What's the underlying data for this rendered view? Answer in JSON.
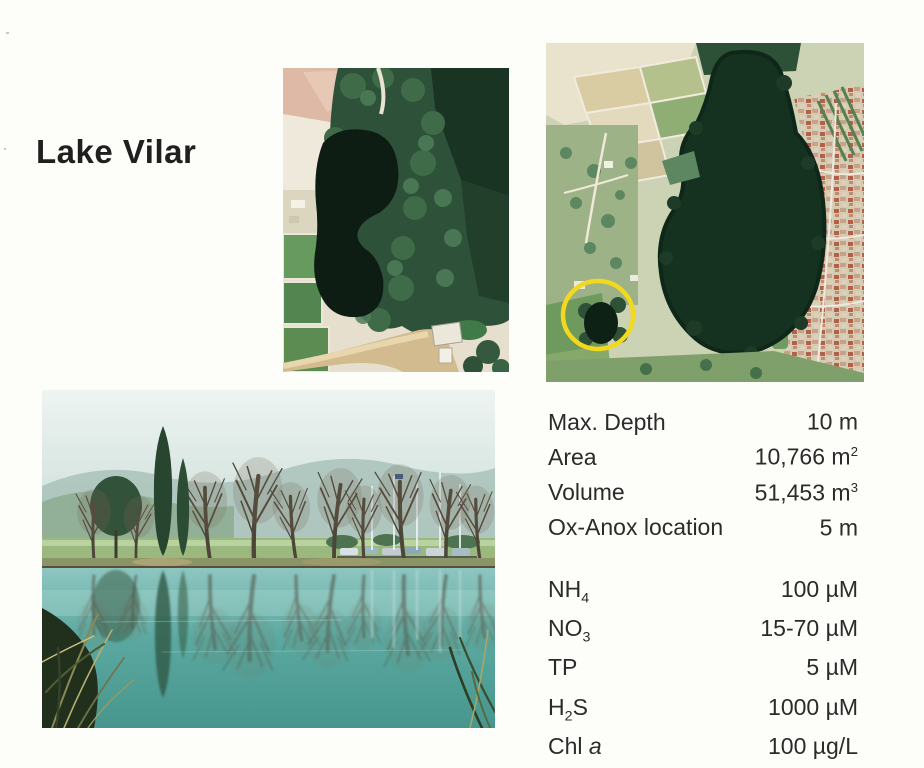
{
  "page": {
    "title": "Lake Vilar",
    "background": "#fdfdfa"
  },
  "colors": {
    "highlight_circle": "#f2d81e",
    "text": "#262626",
    "lake_dark": "#0d1f14",
    "water_teal": "#57a8a0"
  },
  "figures": {
    "aerial_closeup": {
      "alt": "aerial photo of small dark Lake Vilar surrounded by trees and fields"
    },
    "aerial_region": {
      "alt": "aerial photo of lake region with town, yellow circle marking Lake Vilar"
    },
    "ground_photo": {
      "alt": "shoreline photo of Lake Vilar with bare trees reflected in teal water"
    }
  },
  "stats": {
    "physical": [
      {
        "label": "Max. Depth",
        "value": "10 m",
        "value_sup": ""
      },
      {
        "label": "Area",
        "value": "10,766 m",
        "value_sup": "2"
      },
      {
        "label": "Volume",
        "value": "51,453 m",
        "value_sup": "3"
      },
      {
        "label": "Ox-Anox location",
        "value": "5 m",
        "value_sup": ""
      }
    ],
    "chemical": [
      {
        "label_pre": "NH",
        "label_sub": "4",
        "label_post": "",
        "label_ital": "",
        "value": "100 µM"
      },
      {
        "label_pre": "NO",
        "label_sub": "3",
        "label_post": "",
        "label_ital": "",
        "value": "15-70 µM"
      },
      {
        "label_pre": "TP",
        "label_sub": "",
        "label_post": "",
        "label_ital": "",
        "value": "5 µM"
      },
      {
        "label_pre": "H",
        "label_sub": "2",
        "label_post": "S",
        "label_ital": "",
        "value": "1000 µM"
      },
      {
        "label_pre": "Chl ",
        "label_sub": "",
        "label_post": "",
        "label_ital": "a",
        "value": "100 µg/L"
      }
    ]
  }
}
